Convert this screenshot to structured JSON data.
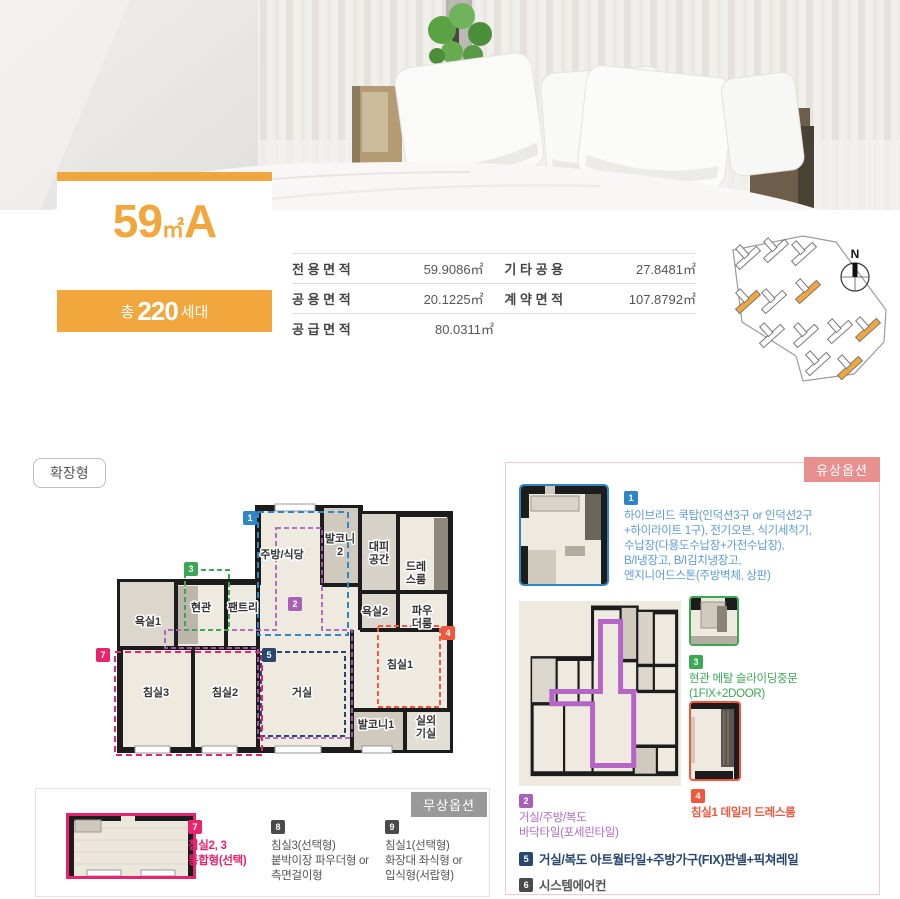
{
  "title": {
    "number": "59",
    "unit": "㎡",
    "type": "A"
  },
  "household": {
    "prefix": "총",
    "count": "220",
    "suffix": "세대"
  },
  "area_table": {
    "rows": [
      {
        "c1_label": "전 용 면 적",
        "c1_value": "59.9086㎡",
        "c2_label": "기 타 공 용",
        "c2_value": "27.8481㎡"
      },
      {
        "c1_label": "공 용 면 적",
        "c1_value": "20.1225㎡",
        "c2_label": "계 약 면 적",
        "c2_value": "107.8792㎡"
      },
      {
        "c1_label": "공 급 면 적",
        "c1_value": "80.0311㎡"
      }
    ]
  },
  "site_plan": {
    "compass": "N"
  },
  "plan_type": "확장형",
  "floor_plan": {
    "rooms": {
      "bath1": "욕실1",
      "entry": "현관",
      "pantry": "팬트리",
      "kitchen": "주방/식당",
      "balcony2_line1": "발코니",
      "balcony2_line2": "2",
      "shelter_line1": "대피",
      "shelter_line2": "공간",
      "dress_line1": "드레",
      "dress_line2": "스룸",
      "bath2": "욕실2",
      "powder_line1": "파우",
      "powder_line2": "더룸",
      "bed3": "침실3",
      "bed2": "침실2",
      "living": "거실",
      "bed1": "침실1",
      "balcony1": "발코니1",
      "outdoor_line1": "실외",
      "outdoor_line2": "기실"
    },
    "badges": {
      "b1": "1",
      "b2": "2",
      "b3": "3",
      "b4": "4",
      "b5": "5",
      "b7": "7"
    }
  },
  "paid_options": {
    "header": "유상옵션",
    "items": [
      {
        "num": "1",
        "color": "#2e86c8",
        "lines": [
          "하이브리드 쿡탑(인덕션3구 or 인덕션2구",
          "+하이라이트 1구), 전기오븐, 식기세척기,",
          "수납장(다용도수납장+가전수납장),",
          "B/I냉장고, B/I김치냉장고,",
          "엔지니어드스톤(주방벽체, 상판)"
        ]
      },
      {
        "num": "2",
        "color": "#a85fb8",
        "lines": [
          "거실/주방/복도",
          "바닥타일(포세린타일)"
        ]
      },
      {
        "num": "3",
        "color": "#3ca854",
        "lines": [
          "현관 메탈 슬라이딩중문",
          "(1FIX+2DOOR)"
        ]
      },
      {
        "num": "4",
        "color": "#f0573c",
        "lines": [
          "침실1 데일리 드레스룸"
        ]
      },
      {
        "num": "5",
        "color": "#27476e",
        "lines": [
          "거실/복도 아트월타일+주방가구(FIX)판넬+픽쳐레일"
        ]
      },
      {
        "num": "6",
        "color": "#4a4a4a",
        "lines": [
          "시스템에어컨"
        ]
      }
    ]
  },
  "free_options": {
    "header": "무상옵션",
    "items": [
      {
        "num": "7",
        "color": "#e8246e",
        "lines": [
          "침실2, 3",
          "통합형(선택)"
        ]
      },
      {
        "num": "8",
        "color": "#4a4a4a",
        "lines": [
          "침실3(선택형)",
          "붙박이장 파우더형 or",
          "측면걸이형"
        ]
      },
      {
        "num": "9",
        "color": "#4a4a4a",
        "lines": [
          "침실1(선택형)",
          "화장대 좌식형 or",
          "입식형(서랍형)"
        ]
      }
    ]
  },
  "colors": {
    "accent_orange": "#f1a73e",
    "paid_tab": "#e89090",
    "free_tab": "#999999",
    "badge_blue": "#2e86c8",
    "badge_purple": "#a85fb8",
    "badge_green": "#3ca854",
    "badge_red": "#f0573c",
    "badge_navy": "#27476e",
    "badge_gray": "#4a4a4a",
    "badge_pink": "#e8246e"
  }
}
